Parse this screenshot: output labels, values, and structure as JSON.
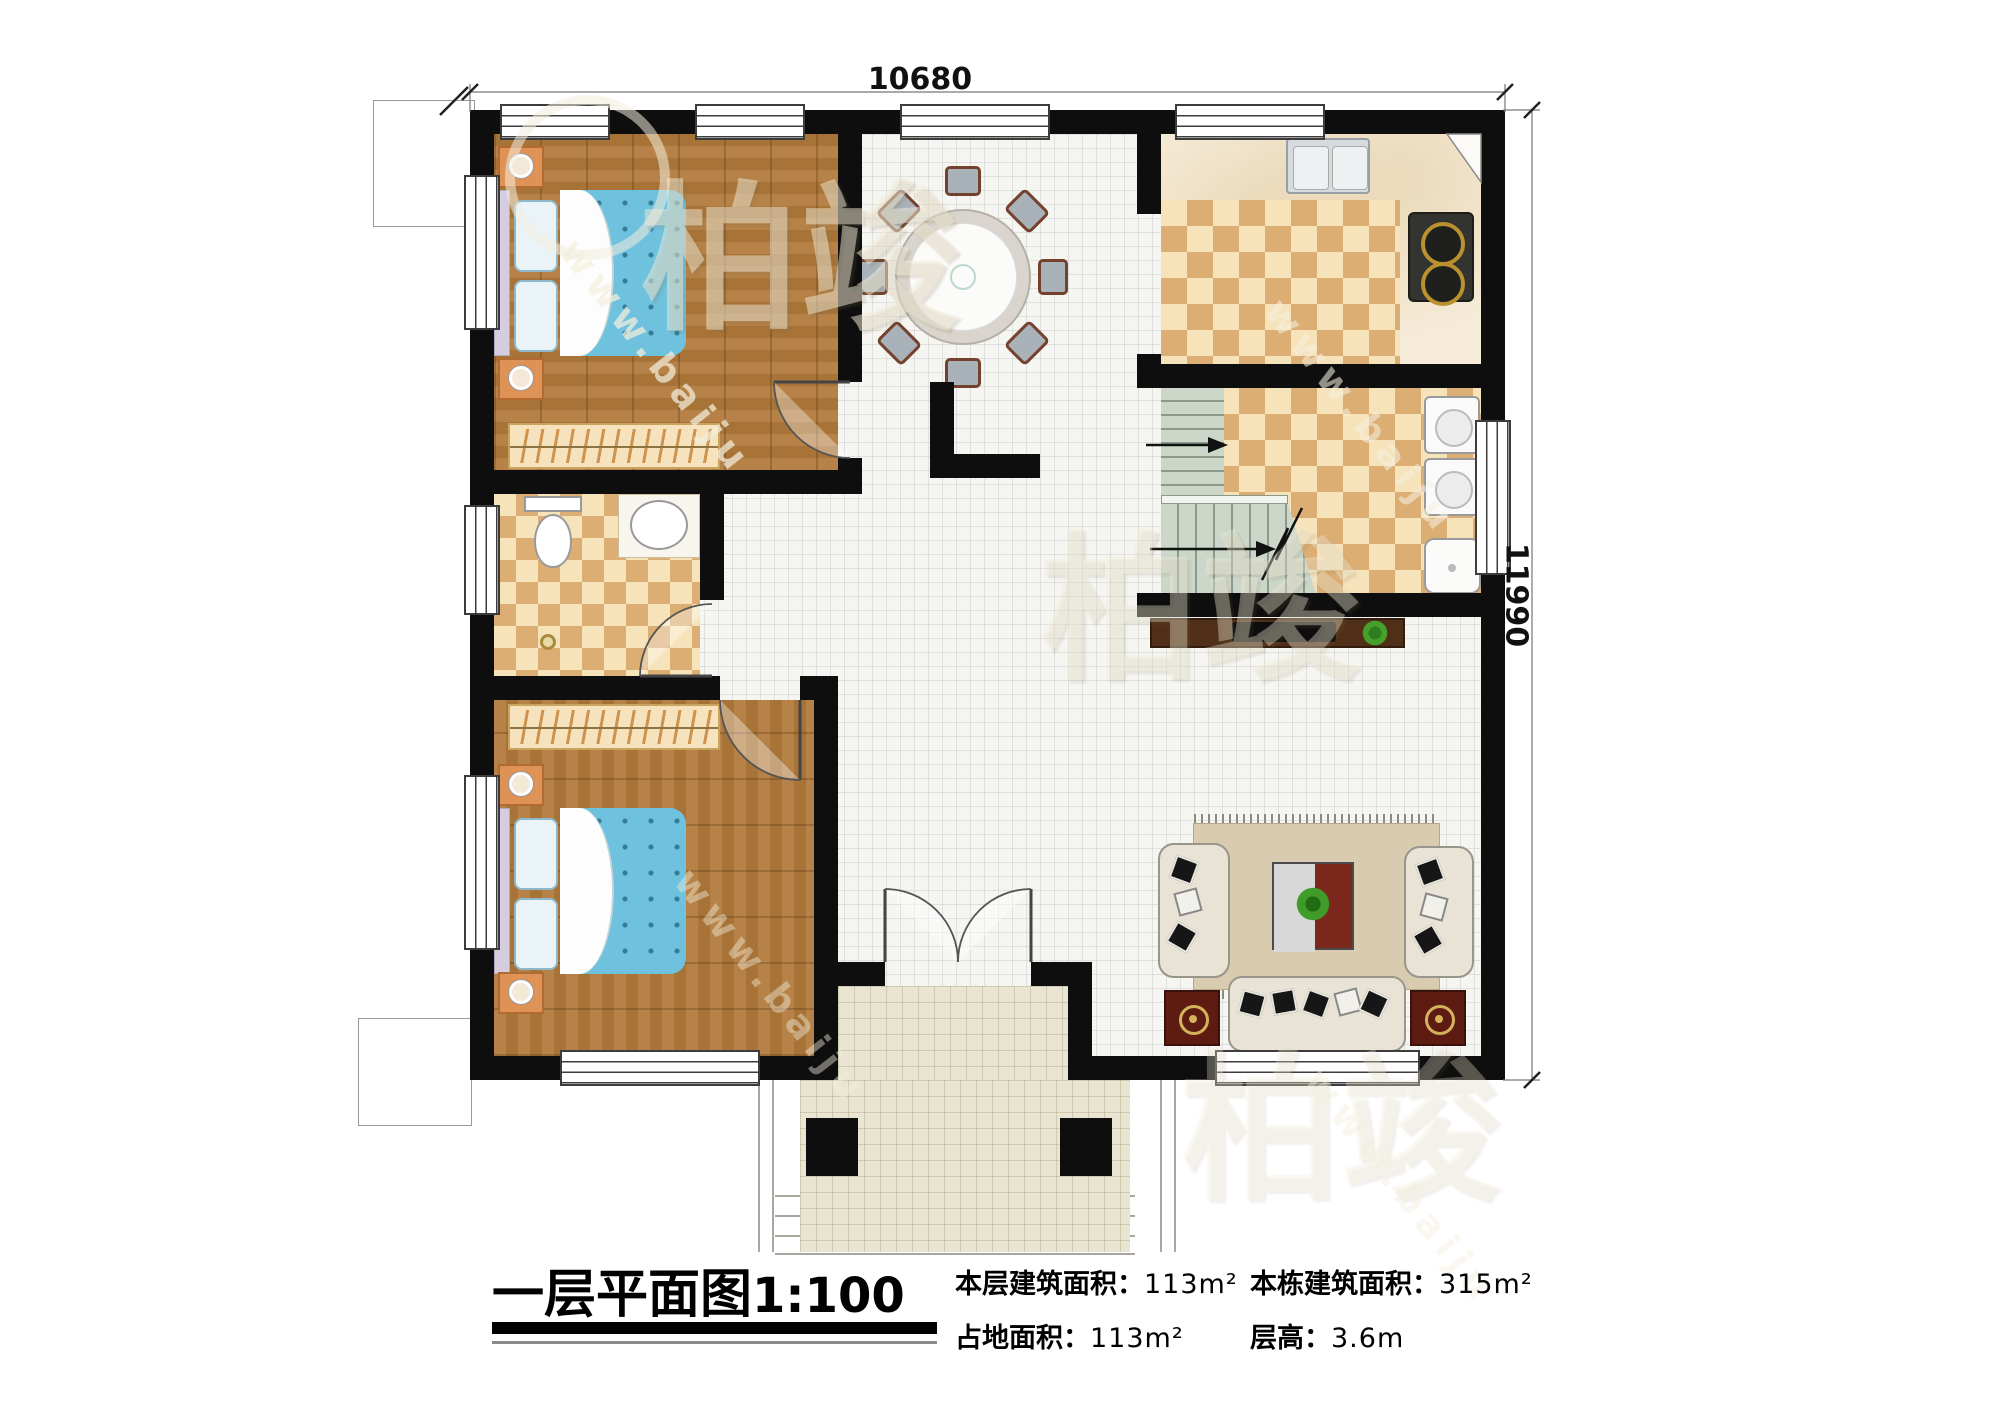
{
  "rooms": {
    "bedroom1": {
      "name": "卧室",
      "area": "12.04m²"
    },
    "bedroom2": {
      "name": "卧室",
      "area": "12.72m²"
    },
    "dining": {
      "name": "餐厅",
      "area": "11.54m²"
    },
    "kitchen": {
      "name": "厨房",
      "area": "8.40m²"
    },
    "laundry": {
      "name": "洗衣区",
      "area": "7.99m²"
    },
    "bathroom": {
      "name": "公卫",
      "area": "4.47m²"
    },
    "hall": {
      "area": "6.55m²"
    },
    "foyer": {
      "name": "门厅"
    },
    "living": {
      "name": "客厅",
      "area": "28.08m²"
    },
    "porch": {
      "name": "入户门廊"
    }
  },
  "stairs": {
    "down_label": "下",
    "up_label": "上"
  },
  "dimensions": {
    "width_mm": "10680",
    "height_mm": "11990"
  },
  "title_block": {
    "title": "一层平面图",
    "scale": "1:100",
    "stats": [
      {
        "label": "本层建筑面积：",
        "value": "113m²"
      },
      {
        "label": "本栋建筑面积：",
        "value": "315m²"
      },
      {
        "label": "占地面积：",
        "value": "113m²"
      },
      {
        "label": "层高：",
        "value": "3.6m"
      }
    ]
  },
  "watermark": {
    "site": "www.baiju",
    "brand": "柏竣"
  },
  "colors": {
    "wall": "#0e0e0e",
    "wood": "#b0793a",
    "checker-dark": "#dcae74",
    "checker-light": "#f6e3ba",
    "stair": "#ccd6c9",
    "porch": "#eae5d2",
    "bed-blue": "#6fc2de",
    "mat-red": "#5e1b12",
    "console-brown": "#4f2f17"
  }
}
